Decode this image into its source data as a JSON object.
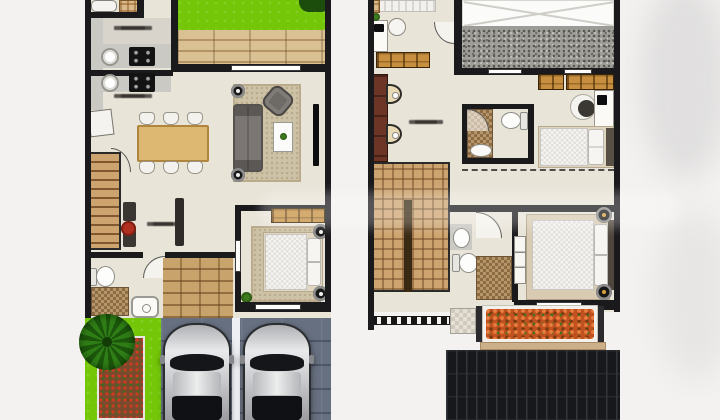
{
  "image": {
    "kind": "architectural floor plan rendering, two storeys side by side",
    "left_plan": "ground floor with kitchen, dining, living room, bedroom, bathrooms, garden strip and double carport with two cars",
    "right_plan": "upper floor with three bedrooms, two bathrooms, stairs, planter box and tiled roof",
    "width": 720,
    "height": 420
  },
  "palette": {
    "floor": "#e9e4d8",
    "wall": "#1a191c",
    "grass": "#74c708",
    "deck": "#d9c194",
    "deck_line": "#b3placeholder",
    "counter": "#cbc9c4",
    "table": "#ddb872",
    "rug": "#cec2a6",
    "sofa": "#7b7673",
    "carport": "#677080",
    "carport_line": "#4c5565",
    "stairs": "#cda470",
    "stairs_line": "#80582f",
    "cabinet": "#c78f3f",
    "mosaic": "#b5956a",
    "mosaic_dark": "#8d6c44",
    "vanity": "#6d3526",
    "flowers": "#c25120",
    "roof_dark": "#17181b",
    "roof_ridge": "#34363b",
    "roof_speckle_base": "#a09e99",
    "roof_speckle_dot": "#57554f"
  },
  "labels": [
    {
      "id": "wet-kitchen-label",
      "legible": false
    },
    {
      "id": "dry-kitchen-label",
      "legible": false
    },
    {
      "id": "foyer-label",
      "legible": false
    },
    {
      "id": "upper-hall-label",
      "legible": false
    }
  ],
  "objects": {
    "cars": 2,
    "palm_trees": 1,
    "dining_seats": 6,
    "beds_visible": 5
  },
  "watermark": {
    "present": true,
    "legible": false
  }
}
